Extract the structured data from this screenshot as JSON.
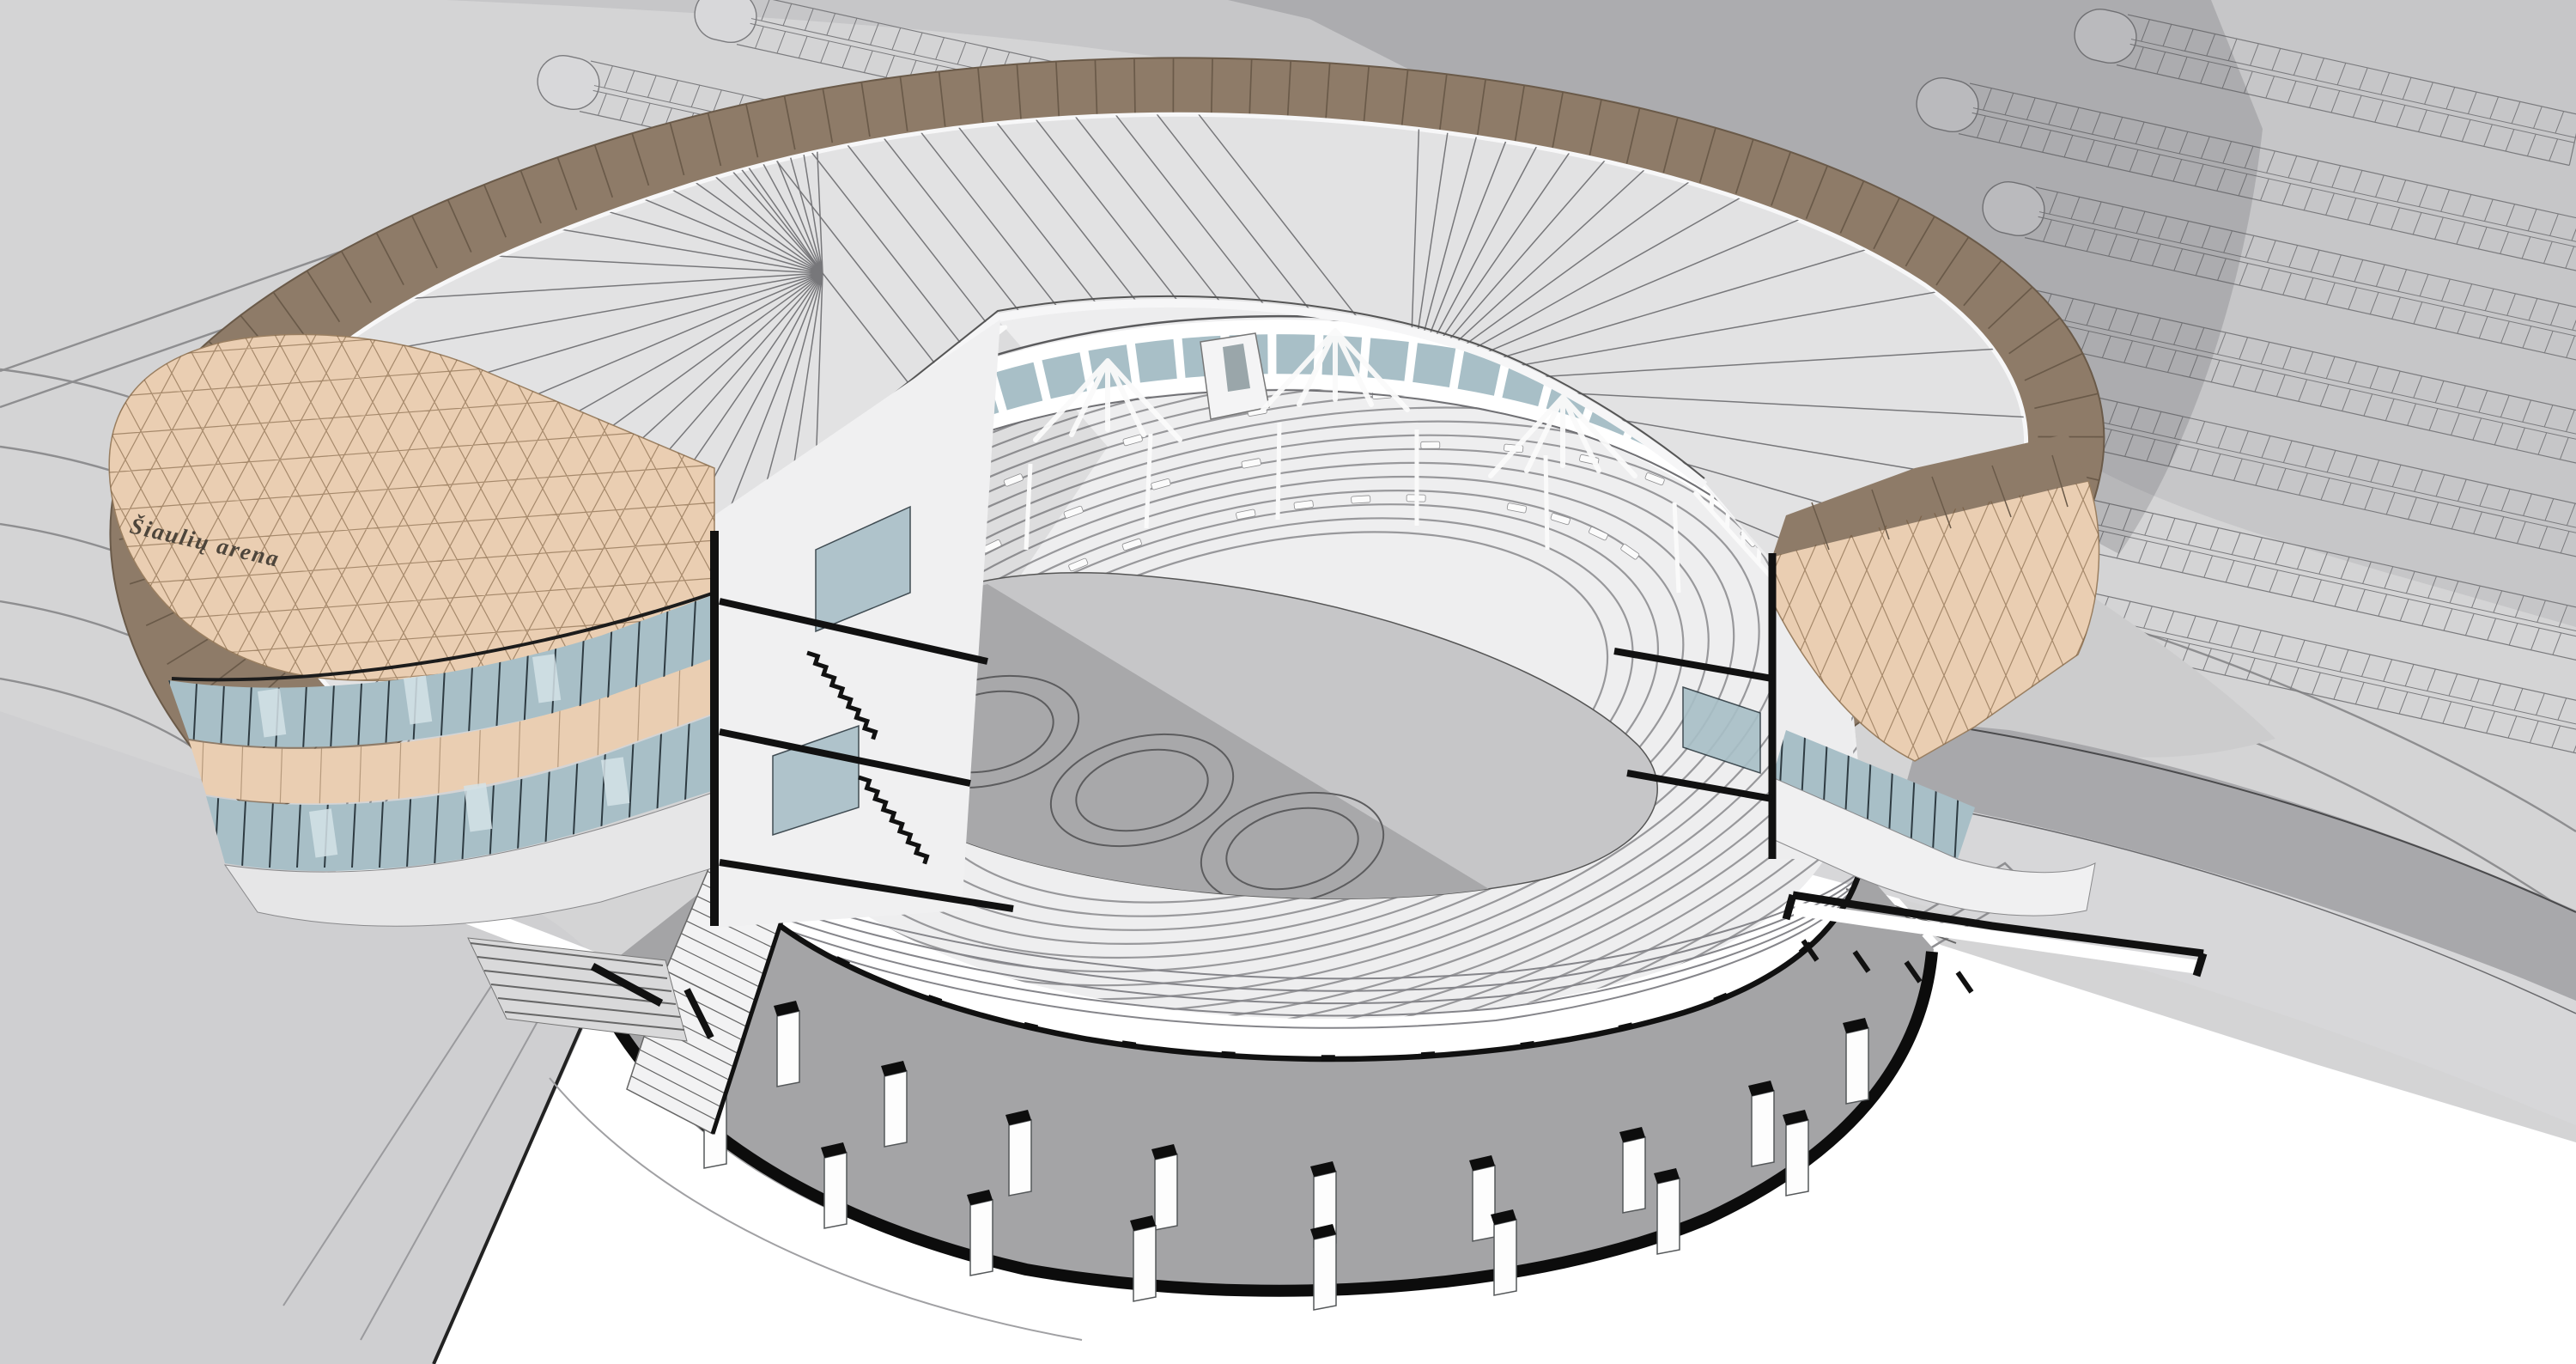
{
  "facade": {
    "signage_text": "Šiaulių arena"
  },
  "scene": {
    "practice_rings_on_floor": 3,
    "parking_rows_right_lot": 7,
    "parking_rows_top_lot": 2,
    "foyer_columns": 17,
    "entrance_steps": 6
  },
  "colors": {
    "background": "#d4d4d5",
    "parking_field": "#c6c6c8",
    "parking_line": "#7b7b7e",
    "shadow": "rgba(70,70,76,0.20)",
    "roof_band": "#8e7b68",
    "roof_band_line": "#6a5a49",
    "roof_plate": "#e2e2e3",
    "roof_seam": "#77777a",
    "facade_lattice": "#eaceb2",
    "facade_lattice_line": "rgba(110,80,50,0.55)",
    "glazing": "#a8bfc7",
    "glazing_light": "#d3e2e6",
    "mullion": "#2e3b42",
    "interior_bg": "#ededee",
    "seating_fill": "#eeeeef",
    "tier_line": "#98989b",
    "seat_dash": "#fbfbfb",
    "floor": "#c6c6c8",
    "floor_shadow": "#a8a8aa",
    "foyer": "#a4a4a6",
    "cut_black": "#111111",
    "white": "#ffffff",
    "ground_line": "#8e8e90",
    "truss": "#fafafa",
    "plaza": "#cfcfd1",
    "terrace_light": "#d7d7d9",
    "terrace_dark": "#a8a8ab",
    "podium": "#cccccd",
    "signage_color": "#4d453b"
  }
}
